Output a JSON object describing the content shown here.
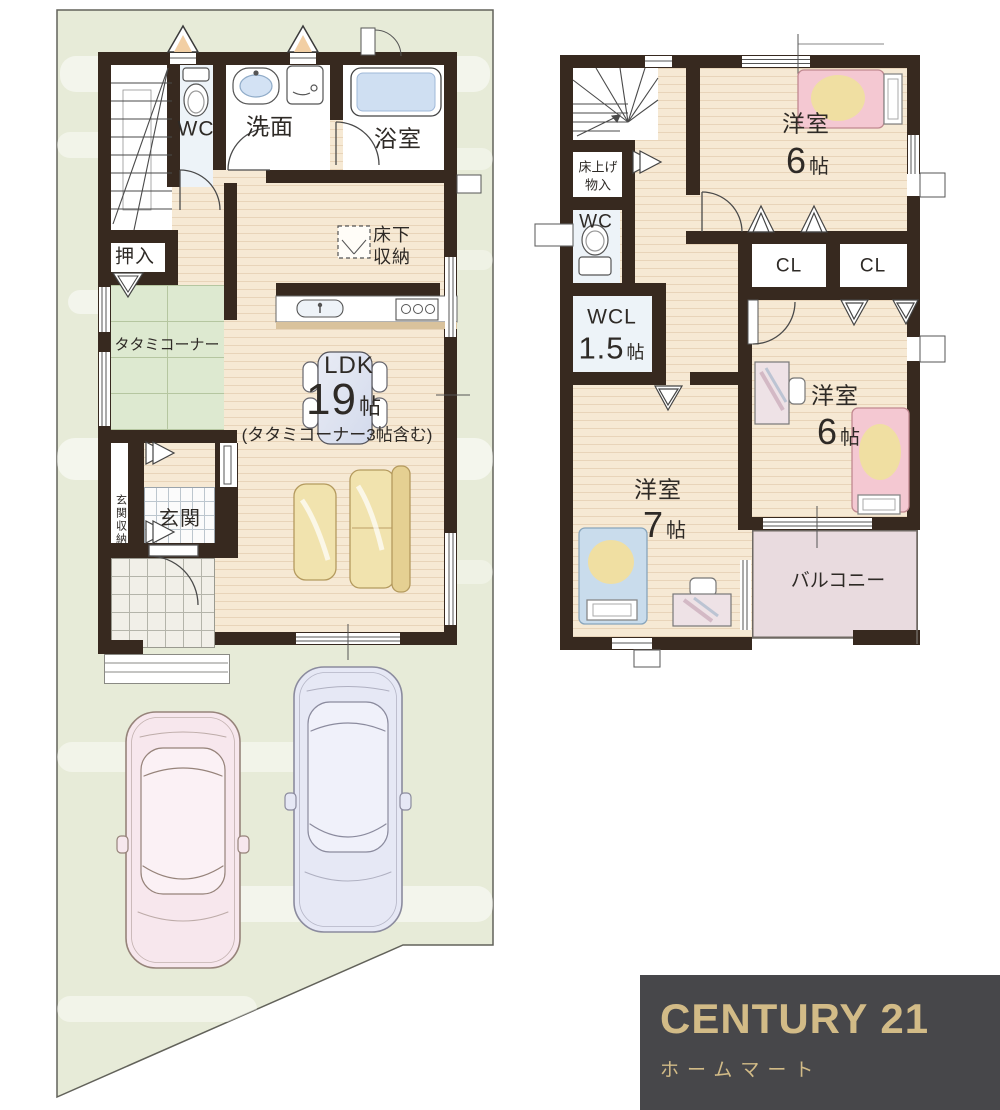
{
  "floor1": {
    "wc": "WC",
    "washroom": "洗面",
    "bath": "浴室",
    "oshiire": "押入",
    "tatami": "タタミコーナー",
    "underfloor1": "床下",
    "underfloor2": "収納",
    "ldk": "LDK",
    "ldk_num": "19",
    "ldk_unit": "帖",
    "ldk_note": "(タタミコーナー3帖含む)",
    "genkan": "玄関",
    "genkan_storage": "玄関収納"
  },
  "floor2": {
    "floor_storage1": "床上げ",
    "floor_storage2": "物入",
    "wc": "WC",
    "wcl": "WCL",
    "wcl_num": "1.5",
    "wcl_unit": "帖",
    "bedroom_a": "洋室",
    "bedroom_a_num": "6",
    "bedroom_a_unit": "帖",
    "bedroom_b": "洋室",
    "bedroom_b_num": "6",
    "bedroom_b_unit": "帖",
    "bedroom_c": "洋室",
    "bedroom_c_num": "7",
    "bedroom_c_unit": "帖",
    "closet_a": "CL",
    "closet_b": "CL",
    "balcony": "バルコニー"
  },
  "logo": {
    "brand": "CENTURY 21",
    "store": "ホームマート"
  },
  "colors": {
    "wall": "#37291f",
    "wood": "#f6e9d4",
    "tatami": "#dde9d0",
    "lot": "#e7ebd8",
    "balcony": "#e9dbdf",
    "gold": "#d2bb87",
    "logo_bg": "#47474a"
  }
}
